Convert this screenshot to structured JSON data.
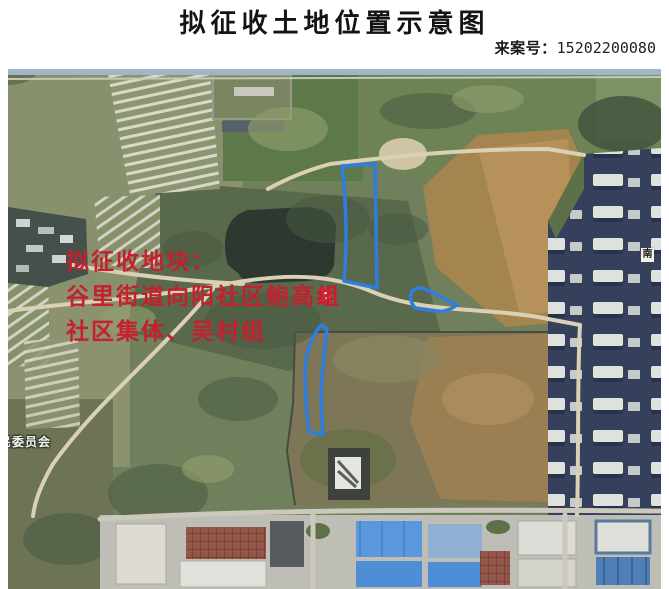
{
  "header": {
    "title": "拟征收土地位置示意图",
    "case_label": "来案号：",
    "case_number": "15202200080"
  },
  "map": {
    "annotation_lines": [
      "拟征收地块：",
      "谷里街道向阳社区鲍高组",
      "社区集体、吴村组"
    ],
    "annotation_color": "#c5202e",
    "parcel_outline_color": "#2e7de0",
    "parcels": [
      "north-parcel",
      "east-parcel",
      "south-parcel"
    ],
    "labels": {
      "committee": "民委员会",
      "marker": "南"
    }
  }
}
